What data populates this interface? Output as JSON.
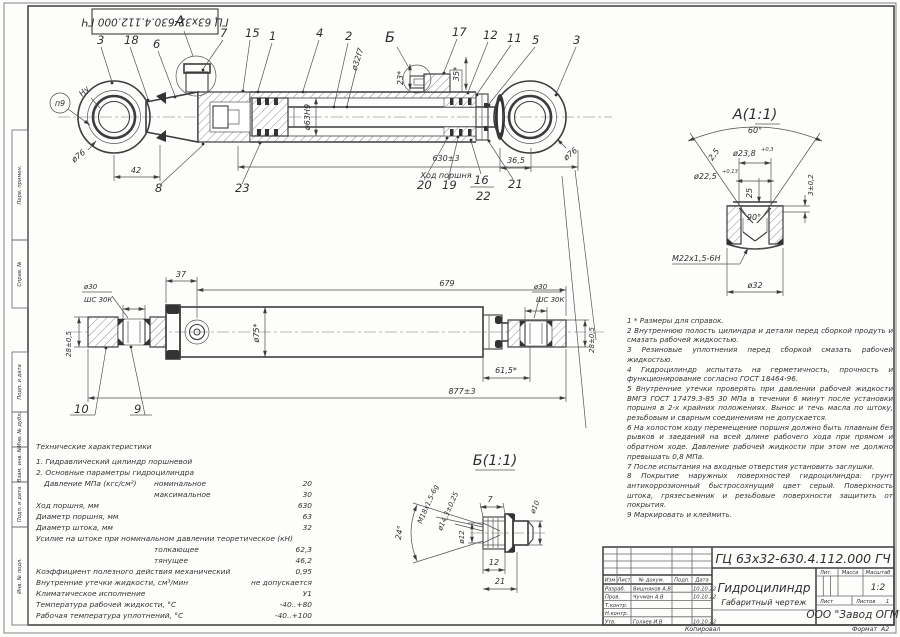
{
  "frame": {
    "top_stamp": "ГЦ 63х32-630.4.112.000 ГЧ",
    "margin_stamps": [
      "Перв. примен.",
      "Справ. №",
      "Подп. и дата",
      "Инв. № дубл.",
      "Взам. инв. №",
      "Подп. и дата",
      "Инв. № подл."
    ],
    "footer": {
      "kopiroval": "Копировал",
      "format_label": "Формат",
      "format_value": "А2"
    }
  },
  "view_main": {
    "marker_circle": "п9",
    "weld_mark": "Ну",
    "labels": {
      "l3a": "3",
      "l18": "18",
      "l6": "6",
      "lA": "А",
      "l7": "7",
      "l15": "15",
      "l1": "1",
      "l4": "4",
      "l2": "2",
      "lB": "Б",
      "l17": "17",
      "l12": "12",
      "l11": "11",
      "l5": "5",
      "l3b": "3",
      "l8": "8",
      "l23": "23",
      "l20": "20",
      "l19": "19",
      "l16": "16",
      "l22": "22",
      "l21": "21"
    },
    "dims": {
      "d76l": "ø76",
      "d42": "42",
      "d630": "630±3",
      "stroke_note": "Ход поршня",
      "d63": "ø63Н9",
      "d32": "ø32f7",
      "a23": "23*",
      "a35": "35*",
      "d365": "36,5",
      "d76r": "ø76"
    }
  },
  "view_side": {
    "labels": {
      "l10": "10",
      "l9": "9"
    },
    "dims": {
      "d37": "37",
      "d679": "679",
      "d75": "ø75*",
      "d877": "877±3",
      "d30l": "ø30",
      "bl": "ШС 30К",
      "d28l": "28±0,5",
      "d30r": "ø30",
      "br": "ШС 30К",
      "d28r": "28±0,5",
      "d615": "61,5*"
    }
  },
  "detail_a": {
    "title": "А(1:1)",
    "dims": {
      "a60": "60°",
      "c25": "2,5",
      "d238": "ø23,8",
      "d238s": "+0,3",
      "d225": "ø22,5",
      "d225s": "+0,13",
      "h25": "25",
      "h3": "3±0,2",
      "a90": "90°",
      "thread": "М22х1,5-6Н",
      "d32": "ø32"
    }
  },
  "detail_b": {
    "title": "Б(1:1)",
    "dims": {
      "thread": "М18х1,5-6g",
      "d143": "ø14,3±0,25",
      "a24": "24°",
      "d12": "ø12",
      "l7": "7",
      "d10": "ø10",
      "l12": "12",
      "l21": "21"
    }
  },
  "tech": {
    "heading": "Технические характеристики",
    "rows": [
      {
        "l": "1. Гидравлический цилиндр поршневой",
        "m": "",
        "v": ""
      },
      {
        "l": "2. Основные параметры гидроцилиндра",
        "m": "",
        "v": ""
      },
      {
        "l": "Давление МПа (кгс/см²)",
        "m": "номинальное",
        "v": "20"
      },
      {
        "l": "",
        "m": "максимальное",
        "v": "30"
      },
      {
        "l": "Ход поршня, мм",
        "m": "",
        "v": "630"
      },
      {
        "l": "Диаметр поршня, мм",
        "m": "",
        "v": "63"
      },
      {
        "l": "Диаметр штока, мм",
        "m": "",
        "v": "32"
      },
      {
        "l": "Усилие на штоке при номинальном давлении теоретическое (кН)",
        "m": "",
        "v": ""
      },
      {
        "l": "",
        "m": "толкающее",
        "v": "62,3"
      },
      {
        "l": "",
        "m": "тянущее",
        "v": "46,2"
      },
      {
        "l": "Коэффициент полезного действия механический",
        "m": "",
        "v": "0,95"
      },
      {
        "l": "Внутренние утечки жидкости, см³/мин",
        "m": "",
        "v": "не допускается"
      },
      {
        "l": "Климатическое исполнение",
        "m": "",
        "v": "У1"
      },
      {
        "l": "Температура рабочей жидкости, °С",
        "m": "",
        "v": "-40..+80"
      },
      {
        "l": "Рабочая температура уплотнений, °С",
        "m": "",
        "v": "-40..+100"
      }
    ]
  },
  "notes": [
    "1 * Размеры для справок.",
    "2 Внутреннюю полость цилиндра и детали перед сборкой продуть и смазать рабочей жидкостью.",
    "3 Резиновые уплотнения перед сборкой смазать рабочей жидкостью.",
    "4 Гидроцилиндр испытать на герметичность, прочность и функционирование согласно ГОСТ 18464-96.",
    "5 Внутренние утечки проверять при давлении рабочей жидкости ВМГЗ ГОСТ 17479.3-85 30 МПа в течении 6 минут после установки поршня в 2-х крайних положениях. Вынос и течь масла по штоку, резьбовым и сварным соединениям не допускается.",
    "6 На холостом ходу перемещение поршня должно быть плавным без рывков и заеданий на всей длине рабочего хода при прямом и обратном ходе. Давление рабочей жидкости при этом не должно превышать 0,8 МПа.",
    "7 После испытания на входные отверстия установить заглушки.",
    "8 Покрытие наружных поверхностей гидроцилиндра: грунт антикоррозионный быстросохнущий цвет серый. Поверхность штока, грязесъемник и резьбовые поверхности защитить от покрытия.",
    "9 Маркировать и клеймить."
  ],
  "titleblock": {
    "code": "ГЦ 63х32-630.4.112.000 ГЧ",
    "name": "Гидроцилиндр",
    "doc_type": "Габаритный чертеж",
    "company": "ООО \"Завод ОГМ\"",
    "cols": {
      "izm": "Изм",
      "list": "Лист",
      "doc": "№ докум.",
      "podp": "Подп.",
      "date": "Дата"
    },
    "right": {
      "lit": "Лит.",
      "mass": "Масса",
      "scale_label": "Масштаб",
      "scale": "1:2",
      "sheet": "Лист",
      "sheets": "Листов",
      "sheets_val": "1"
    },
    "rows": [
      {
        "role": "Разраб.",
        "name": "Вишняков А.В",
        "date": "10.10.22"
      },
      {
        "role": "Пров.",
        "name": "Чучман А.В",
        "date": "10.10.22"
      },
      {
        "role": "Т.контр.",
        "name": "",
        "date": ""
      },
      {
        "role": "Н.контр.",
        "name": "",
        "date": ""
      },
      {
        "role": "Утв.",
        "name": "Голяев И.В",
        "date": "10.10.22"
      }
    ]
  }
}
